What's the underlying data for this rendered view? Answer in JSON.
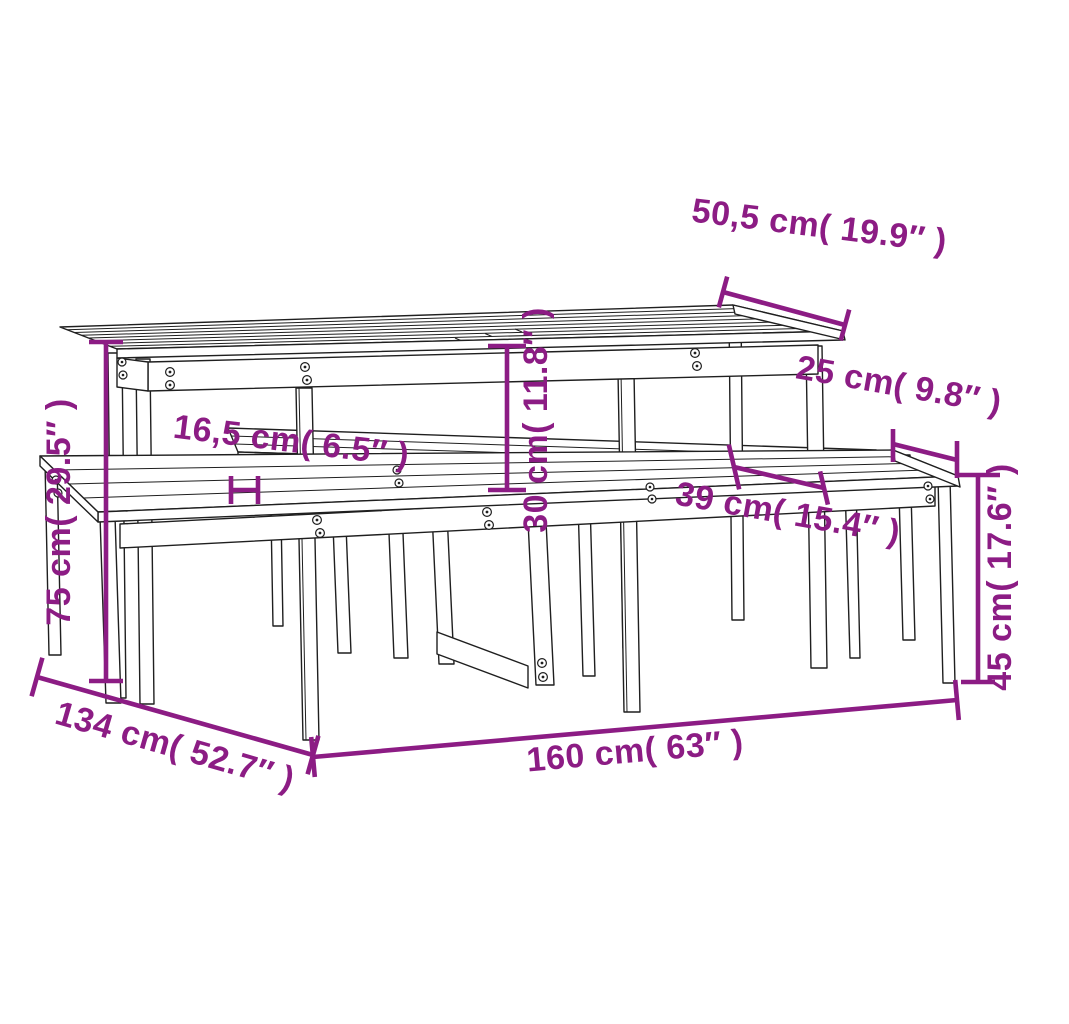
{
  "meta": {
    "type": "product-dimension-diagram",
    "subject": "wooden picnic table with two benches, 3D line drawing",
    "units": [
      "cm",
      "inches"
    ]
  },
  "colors": {
    "dimension_accent": "#8C1C84",
    "drawing_line": "#1f1f1f",
    "background": "#ffffff"
  },
  "dimensions": {
    "tabletop_depth": {
      "label": "50,5 cm( 19.9″ )",
      "cm": "50,5",
      "in": "19.9"
    },
    "bench_seat_depth": {
      "label": "25 cm( 9.8″ )",
      "cm": "25",
      "in": "9.8"
    },
    "tabletop_overhang": {
      "label": "16,5 cm( 6.5″ )",
      "cm": "16,5",
      "in": "6.5"
    },
    "seat_to_tabletop": {
      "label": "30 cm( 11.8″ )",
      "cm": "30",
      "in": "11.8"
    },
    "table_to_bench": {
      "label": "39 cm( 15.4″ )",
      "cm": "39",
      "in": "15.4"
    },
    "table_height": {
      "label": "75 cm( 29.5″ )",
      "cm": "75",
      "in": "29.5"
    },
    "bench_height": {
      "label": "45 cm( 17.6″ )",
      "cm": "45",
      "in": "17.6"
    },
    "total_length": {
      "label": "160 cm( 63″ )",
      "cm": "160",
      "in": "63"
    },
    "total_depth": {
      "label": "134 cm( 52.7″ )",
      "cm": "134",
      "in": "52.7"
    }
  }
}
